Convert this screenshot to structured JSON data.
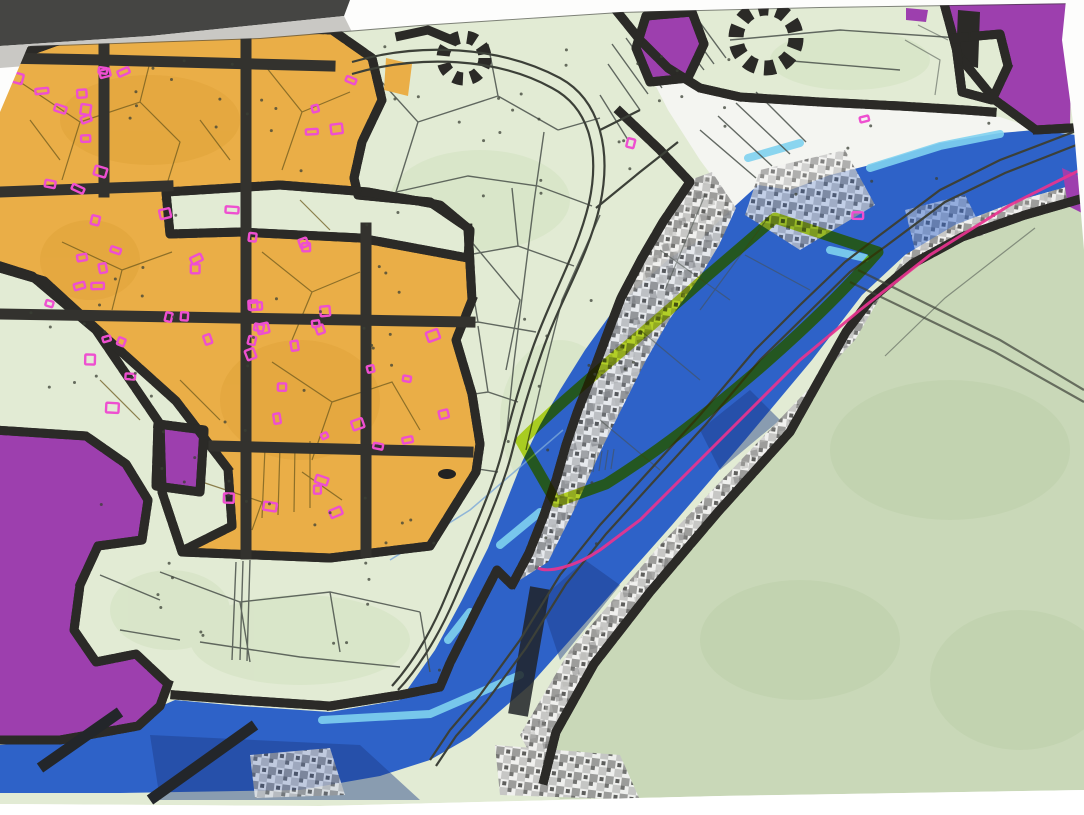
{
  "map": {
    "kind": "photographed printed zoning / cadastral plan, no legible text",
    "paper": {
      "background": "#fdfdfc",
      "shadow": "#454543",
      "sheet_edge": "#c9c8c4",
      "margin": "#ffffff"
    },
    "zones": [
      {
        "name": "built-up-zone-orange",
        "color": "#eaae47"
      },
      {
        "name": "special-zone-purple",
        "color": "#9d3fae"
      },
      {
        "name": "water-flood-zone-blue",
        "color": "#2e62c8"
      },
      {
        "name": "parcel-field-light-green",
        "color": "#e2ebd4"
      },
      {
        "name": "open-land-sage-green",
        "color": "#c9d8b8"
      },
      {
        "name": "hazard-mosaic-gray",
        "color": "#9a9a9a"
      },
      {
        "name": "floodplain-white",
        "color": "#f4f5f1"
      }
    ],
    "overlays": [
      {
        "name": "zone-border-black",
        "color": "#2b2a27"
      },
      {
        "name": "highlighted-parcel-yellow",
        "color": "#c3e21e"
      },
      {
        "name": "boundary-line-magenta",
        "color": "#e8338f"
      },
      {
        "name": "building-footprint-pink",
        "color": "#ee4fd0"
      },
      {
        "name": "water-highlight-cyan",
        "color": "#7fd2ef"
      },
      {
        "name": "deep-water-navy",
        "color": "#1c3c85"
      }
    ]
  }
}
